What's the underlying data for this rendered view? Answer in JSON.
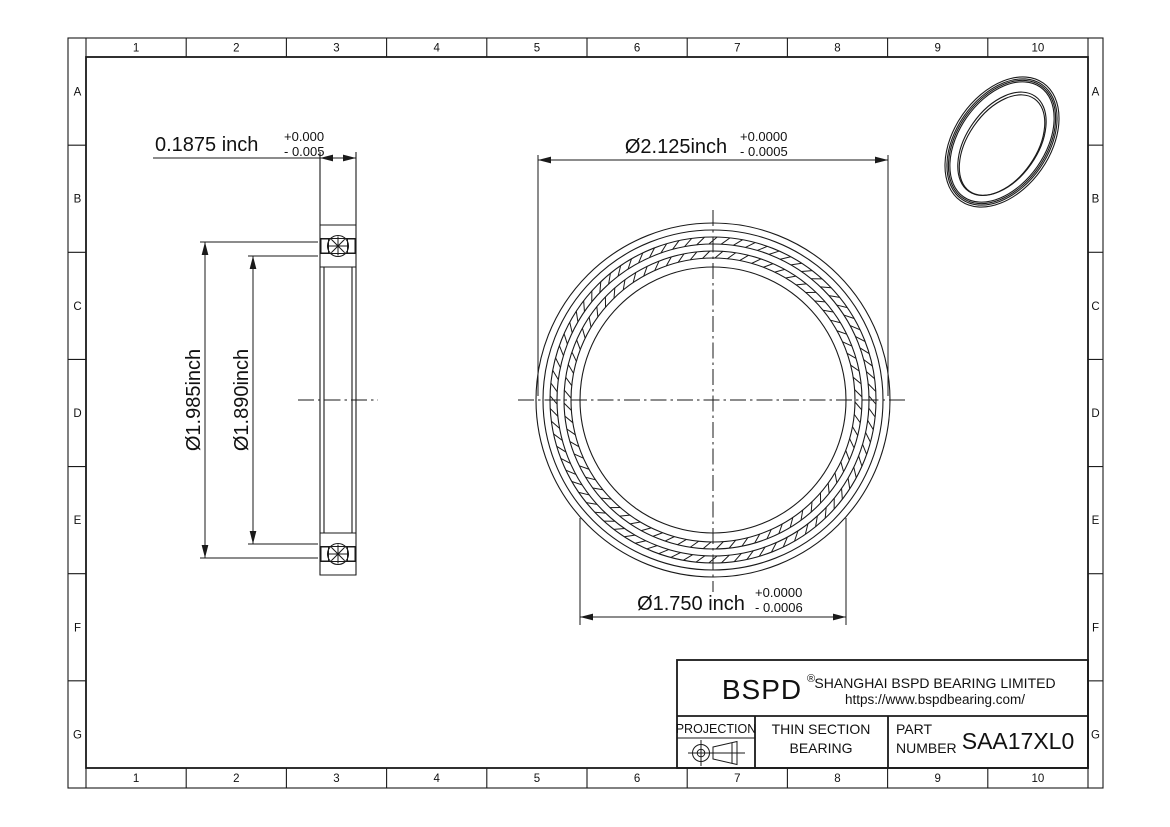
{
  "page": {
    "background": "#ffffff",
    "line_color": "#1a1a1a"
  },
  "grid": {
    "columns": [
      "1",
      "2",
      "3",
      "4",
      "5",
      "6",
      "7",
      "8",
      "9",
      "10"
    ],
    "rows": [
      "A",
      "B",
      "C",
      "D",
      "E",
      "F",
      "G"
    ]
  },
  "views": {
    "section_view": {
      "width_dim": {
        "value": "0.1875 inch",
        "tol_plus": "+0.000",
        "tol_minus": "- 0.005"
      },
      "outer_race_dim": {
        "value": "Ø1.985inch"
      },
      "inner_race_dim": {
        "value": "Ø1.890inch"
      }
    },
    "front_view": {
      "outer_dia_dim": {
        "value": "Ø2.125inch",
        "tol_plus": "+0.0000",
        "tol_minus": "- 0.0005"
      },
      "bore_dia_dim": {
        "value": "Ø1.750 inch",
        "tol_plus": "+0.0000",
        "tol_minus": "- 0.0006"
      }
    }
  },
  "title_block": {
    "logo": "BSPD",
    "registered_mark": "®",
    "company_name": "SHANGHAI BSPD BEARING LIMITED",
    "website": "https://www.bspdbearing.com/",
    "projection_label": "PROJECTION",
    "product_type_line1": "THIN SECTION",
    "product_type_line2": "BEARING",
    "part_label_line1": "PART",
    "part_label_line2": "NUMBER",
    "part_number": "SAA17XL0"
  }
}
